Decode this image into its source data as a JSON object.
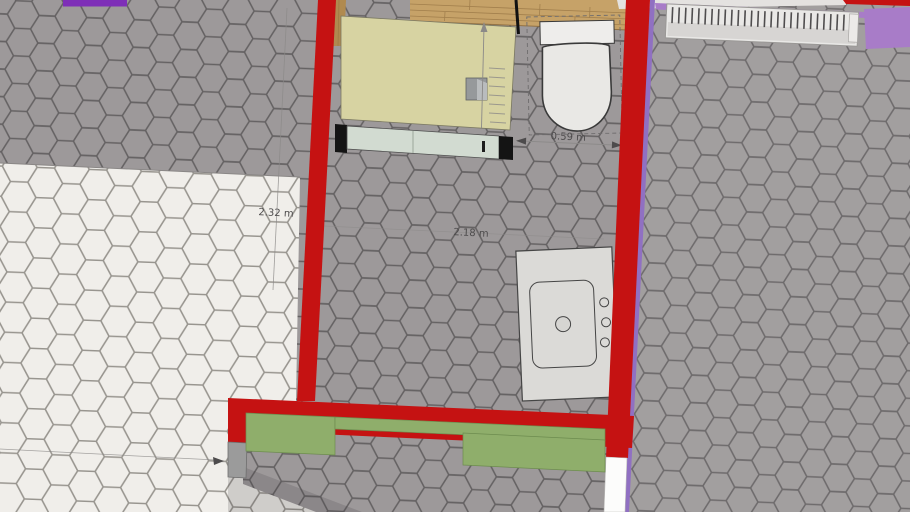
{
  "scene": {
    "description_labels": {
      "left_wall_height_dim": "2.32 m",
      "room_width_dim": "2.18 m",
      "toilet_clearance_dim": "0.59 m"
    },
    "colors": {
      "wall_red": "#c51212",
      "purple_dark": "#7e2fb7",
      "purple_light": "#a87cc8",
      "purple_edge": "#9070c2",
      "tile_gray": "#9d999a",
      "tile_gray_line": "#656263",
      "tile_white": "#f0eeea",
      "tile_white_line": "#98958f",
      "wood": "#c6a268",
      "wood_dark": "#b08a4f",
      "wood_line": "#8f6d3e",
      "cabinet_top": "#d7d3a2",
      "cabinet_edge": "#7a7862",
      "cabinet_front": "#d2dbd1",
      "cap_black": "#141414",
      "fixture_fill": "#e9e8e5",
      "fixture_tank": "#eeedeb",
      "fixture_stroke": "#3a3a3a",
      "sink_fill": "#dbdad7",
      "sink_stroke": "#454545",
      "green": "#8fae6b",
      "green_line": "#6d8c4f",
      "block_gray": "#9b9b9b",
      "block_line": "#6e6e6e",
      "radiator_frame": "#e9e8e6",
      "radiator_band": "#d7d5d3",
      "radiator_line": "#4f4d4e",
      "dim_text": "#4d4b4c",
      "dim_line": "#8b8988",
      "white_gap": "#fcfcfb",
      "white_strip": "#e4e2e0",
      "shadow": "#3c3a3b",
      "cube_gray": "#96999b",
      "cube_light": "#b9bcbe"
    }
  }
}
